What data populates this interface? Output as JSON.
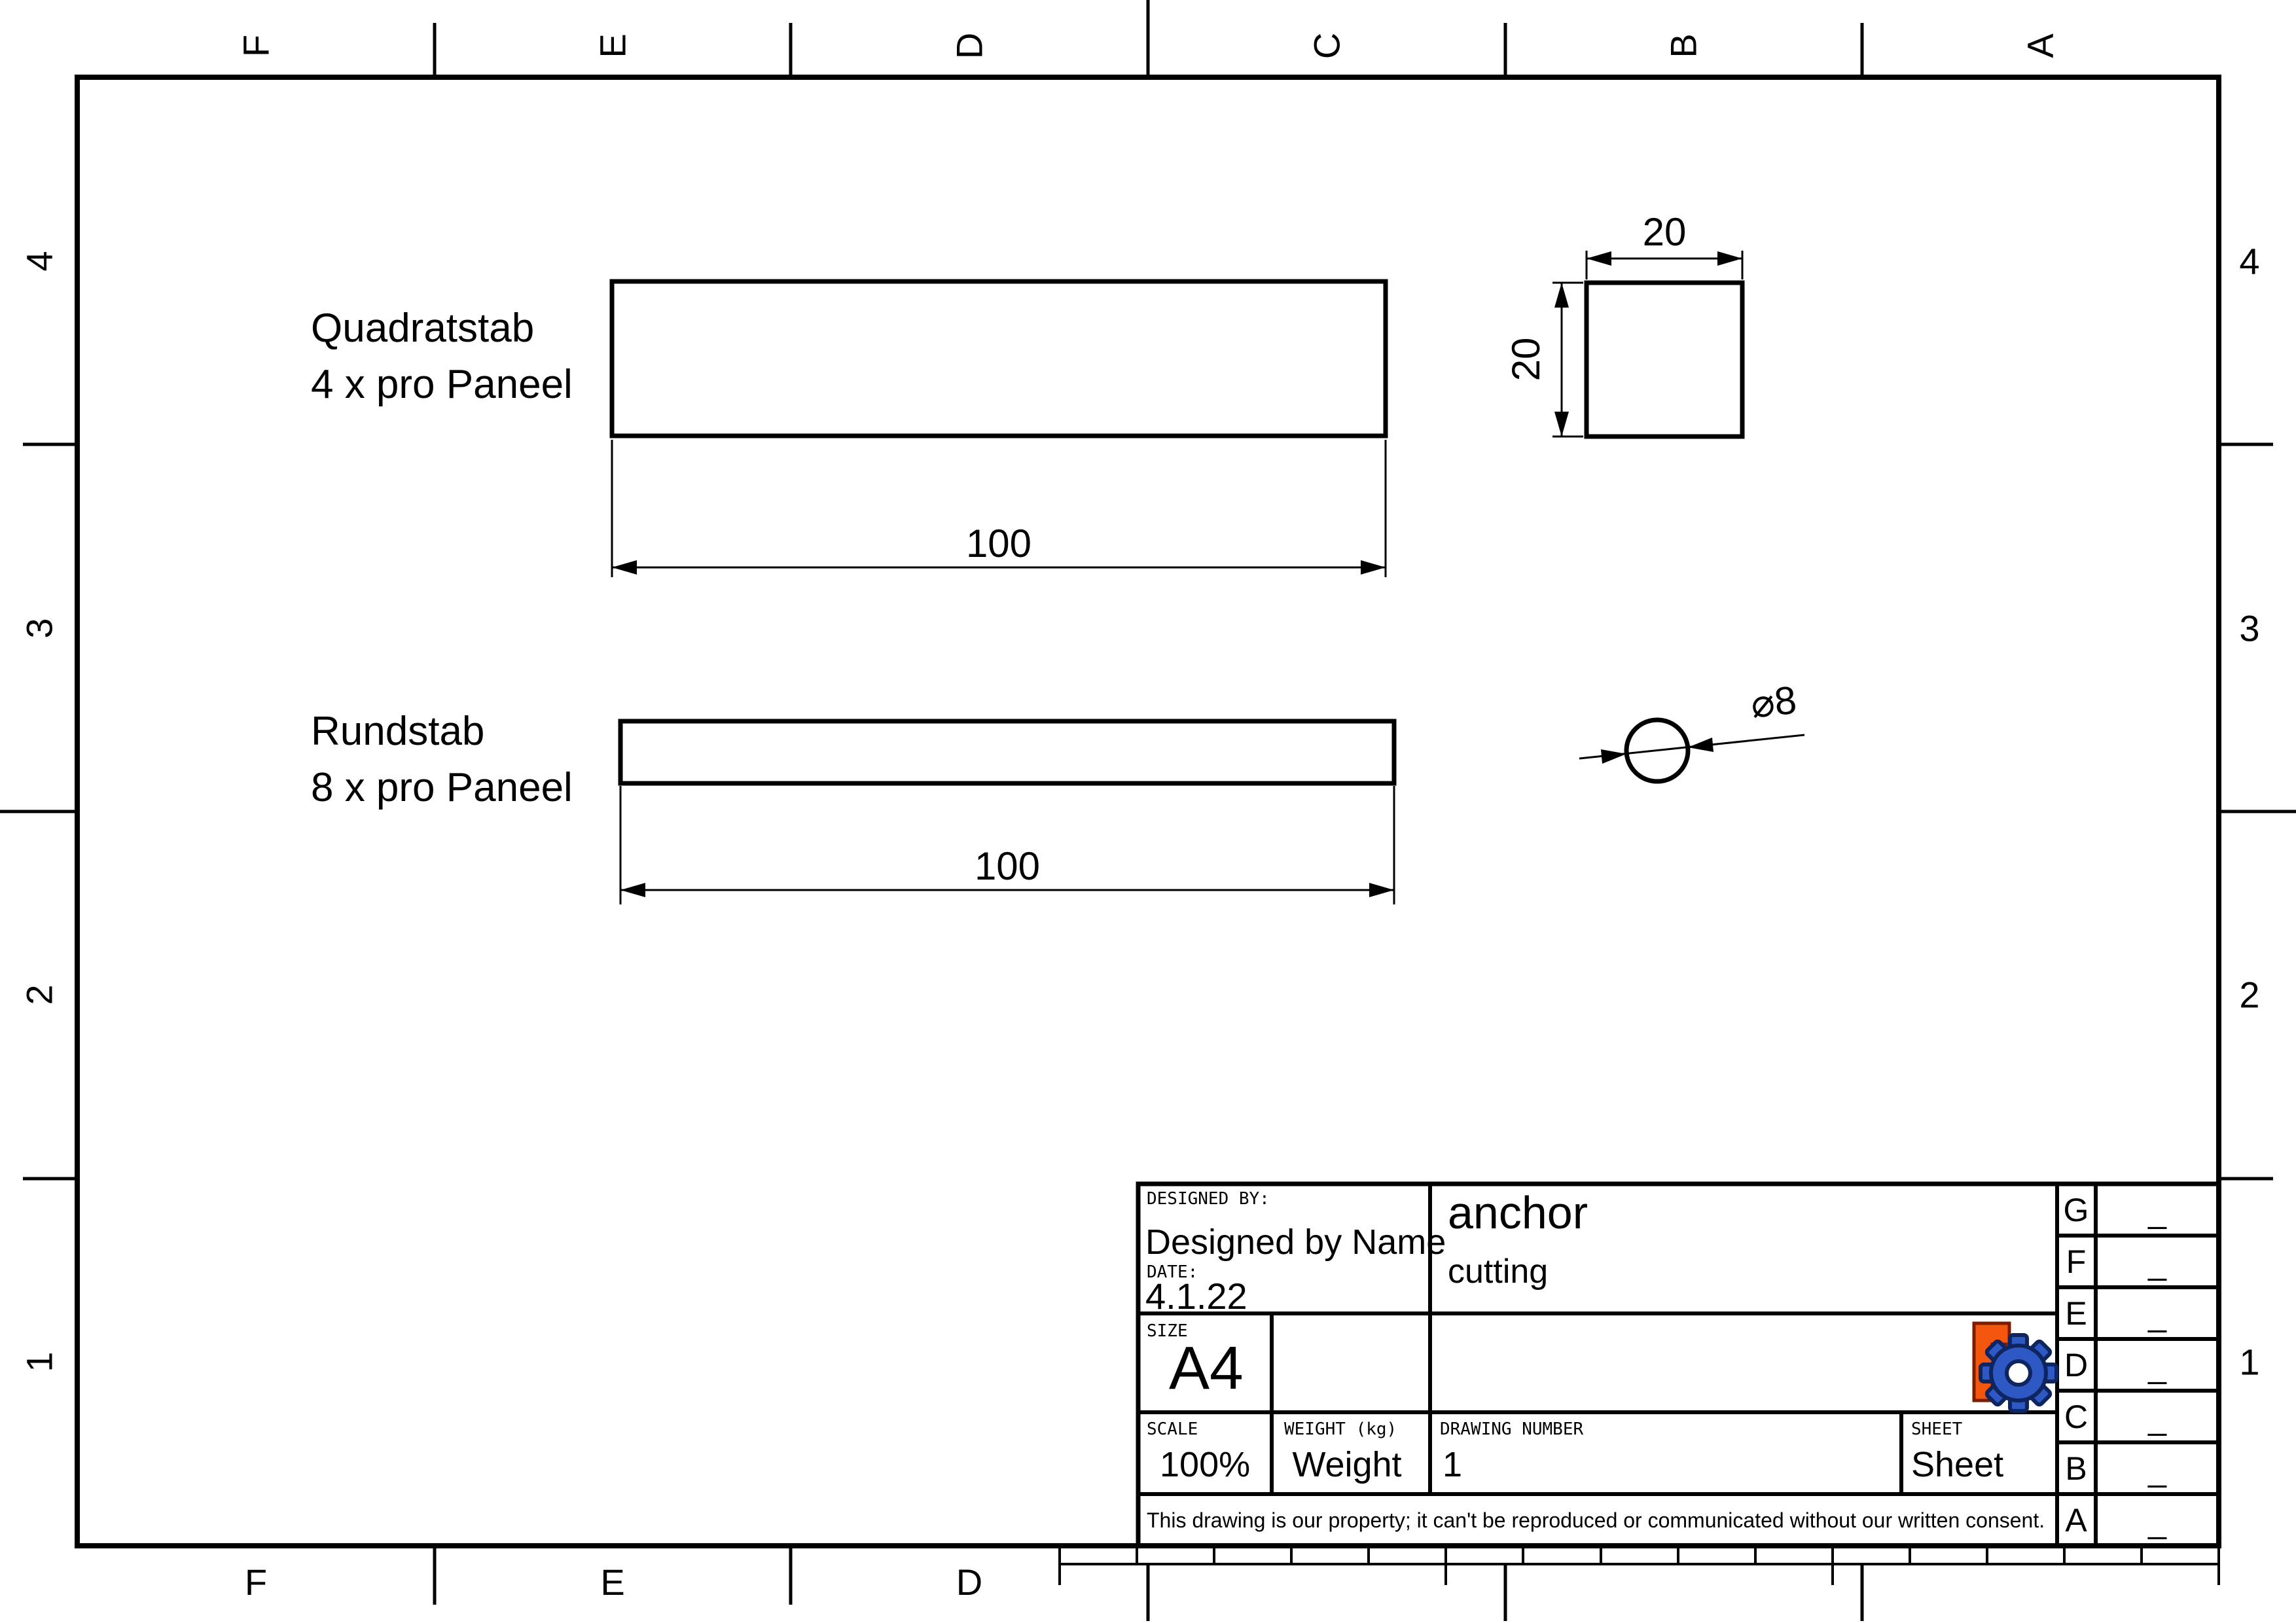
{
  "frame": {
    "top_labels": [
      "F",
      "E",
      "D",
      "C",
      "B",
      "A"
    ],
    "bottom_labels": [
      "F",
      "E",
      "D"
    ],
    "left_labels": [
      "4",
      "3",
      "2",
      "1"
    ],
    "right_labels": [
      "4",
      "3",
      "2",
      "1"
    ]
  },
  "views": {
    "square_bar": {
      "label_line1": "Quadratstab",
      "label_line2": "4 x pro Paneel",
      "length_dim": "100",
      "width_dim": "20",
      "height_dim": "20"
    },
    "round_bar": {
      "label_line1": "Rundstab",
      "label_line2": "8 x pro Paneel",
      "length_dim": "100",
      "diameter_dim": "⌀8"
    }
  },
  "title_block": {
    "designed_by_label": "DESIGNED BY:",
    "designed_by": "Designed by Name",
    "date_label": "DATE:",
    "date": "4.1.22",
    "title": "anchor",
    "subtitle": "cutting",
    "size_label": "SIZE",
    "size": "A4",
    "scale_label": "SCALE",
    "scale": "100%",
    "weight_label": "WEIGHT (kg)",
    "weight": "Weight",
    "drawing_number_label": "DRAWING NUMBER",
    "drawing_number": "1",
    "sheet_label": "SHEET",
    "sheet": "Sheet",
    "disclaimer": "This drawing is our property; it can't be reproduced or communicated without our written consent.",
    "revision_rows": [
      {
        "zone": "G",
        "rev": "_"
      },
      {
        "zone": "F",
        "rev": "_"
      },
      {
        "zone": "E",
        "rev": "_"
      },
      {
        "zone": "D",
        "rev": "_"
      },
      {
        "zone": "C",
        "rev": "_"
      },
      {
        "zone": "B",
        "rev": "_"
      },
      {
        "zone": "A",
        "rev": "_"
      }
    ],
    "logo": {
      "name": "FreeCAD",
      "f_fill": "#f4560e",
      "f_outline": "#7c1d00",
      "gear_fill": "#2e59c4",
      "gear_outline": "#0f2560"
    }
  }
}
